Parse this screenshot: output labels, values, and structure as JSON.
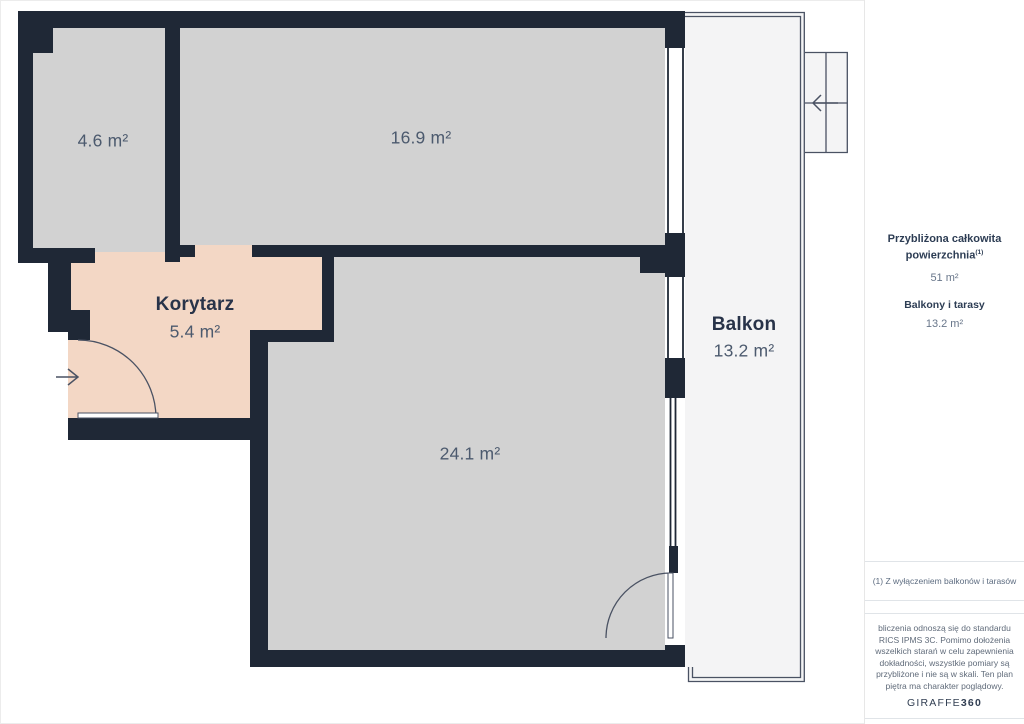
{
  "colors": {
    "wall-color": "#1f2836",
    "room-fill": "#d2d2d2",
    "corridor-fill": "#f3d7c5",
    "balcony-fill": "#f4f4f5",
    "line-color": "#4a5263",
    "label-strong": "#283349",
    "label-muted": "#4c5a6e",
    "sidebar-strong": "#2d3d54",
    "sidebar-muted": "#68768a",
    "border-light": "#e0e4e8"
  },
  "plan": {
    "rooms": [
      {
        "label": "4.6 m²"
      },
      {
        "label": "16.9 m²"
      },
      {
        "name": "Korytarz",
        "label": "5.4 m²"
      },
      {
        "label": "24.1 m²"
      },
      {
        "name": "Balkon",
        "label": "13.2 m²"
      }
    ]
  },
  "sidebar": {
    "total_title": "Przybliżona całkowita powierzchnia",
    "total_sup": "(1)",
    "total_value": "51 m²",
    "balcony_title": "Balkony i tarasy",
    "balcony_value": "13.2 m²",
    "footnote": "(1) Z wyłączeniem balkonów i tarasów",
    "disclaimer_lines": [
      "bliczenia odnoszą się do standardu",
      "RICS IPMS 3C. Pomimo dołożenia",
      "wszelkich starań w celu zapewnienia",
      "dokładności, wszystkie pomiary są",
      "przybliżone i nie są w skali. Ten plan",
      "piętra ma charakter poglądowy."
    ],
    "brand_regular": "GIRAFFE",
    "brand_bold": "360"
  }
}
